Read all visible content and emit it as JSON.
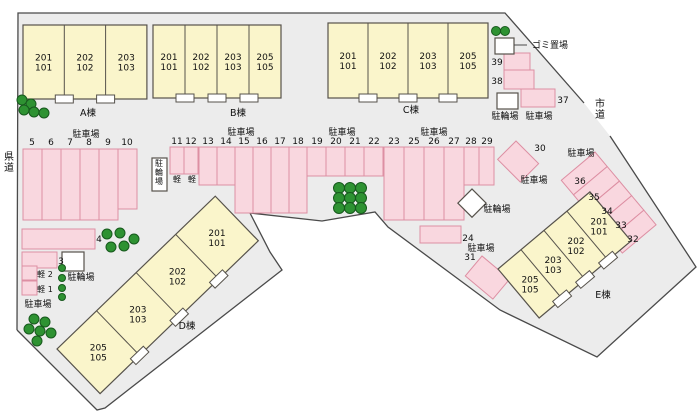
{
  "colors": {
    "parcel": "#ececec",
    "boundary": "#4a4a4a",
    "building_fill": "#faf5cb",
    "building_stroke": "#56524b",
    "stall_fill": "#f9d7df",
    "stall_stroke": "#dd8fa3",
    "tree_fill": "#2e9232",
    "tree_stroke": "#17591d",
    "white_box_fill": "#ffffff",
    "white_box_stroke": "#56524b",
    "text": "#111111"
  },
  "boundary": {
    "fill": "17,330 18,13 505,13 584,103 610,136 696,267 597,357 500,310 388,227 375,212 322,221 250,213 270,252 282,270 105,408 97,410 17,330",
    "outlines": [
      "17,330 18,13 505,13 584,103",
      "610,136 696,267 597,357 500,310 388,227 375,212 322,221 250,213 270,252 282,270 105,408 97,410 17,330"
    ]
  },
  "buildings": [
    {
      "id": "A",
      "label": "A棟",
      "labelPos": [
        88,
        116
      ],
      "origin": [
        23,
        25
      ],
      "unitW": 41.3,
      "depth": 74,
      "rot": 0,
      "units": [
        [
          "201",
          "101"
        ],
        [
          "202",
          "102"
        ],
        [
          "203",
          "103"
        ]
      ]
    },
    {
      "id": "B",
      "label": "B棟",
      "labelPos": [
        238,
        116
      ],
      "origin": [
        153,
        25
      ],
      "unitW": 32,
      "depth": 73,
      "rot": 0,
      "units": [
        [
          "201",
          "101"
        ],
        [
          "202",
          "102"
        ],
        [
          "203",
          "103"
        ],
        [
          "205",
          "105"
        ]
      ]
    },
    {
      "id": "C",
      "label": "C棟",
      "labelPos": [
        411,
        113
      ],
      "origin": [
        328,
        23
      ],
      "unitW": 40,
      "depth": 75,
      "rot": 0,
      "units": [
        [
          "201",
          "101"
        ],
        [
          "202",
          "102"
        ],
        [
          "203",
          "103"
        ],
        [
          "205",
          "105"
        ]
      ]
    },
    {
      "id": "D",
      "label": "D棟",
      "labelPos": [
        187,
        329
      ],
      "origin": [
        57,
        349
      ],
      "unitW": 55,
      "depth": 62,
      "rot": -44,
      "units": [
        [
          "205",
          "105"
        ],
        [
          "203",
          "103"
        ],
        [
          "202",
          "102"
        ],
        [
          "201",
          "101"
        ]
      ]
    },
    {
      "id": "E",
      "label": "E棟",
      "labelPos": [
        603,
        298
      ],
      "origin": [
        498,
        269
      ],
      "unitW": 30,
      "depth": 64,
      "rot": -40,
      "units": [
        [
          "205",
          "105"
        ],
        [
          "203",
          "103"
        ],
        [
          "202",
          "102"
        ],
        [
          "201",
          "101"
        ]
      ]
    }
  ],
  "stalls": [
    {
      "n": "5",
      "x": 23,
      "y": 149,
      "w": 19,
      "h": 71,
      "lx": 32,
      "ly": 145
    },
    {
      "n": "6",
      "x": 42,
      "y": 149,
      "w": 19,
      "h": 71,
      "lx": 51,
      "ly": 145
    },
    {
      "n": "7",
      "x": 61,
      "y": 149,
      "w": 19,
      "h": 71,
      "lx": 70,
      "ly": 145
    },
    {
      "n": "8",
      "x": 80,
      "y": 149,
      "w": 19,
      "h": 71,
      "lx": 89,
      "ly": 145
    },
    {
      "n": "9",
      "x": 99,
      "y": 149,
      "w": 19,
      "h": 71,
      "lx": 108,
      "ly": 145
    },
    {
      "n": "10",
      "x": 118,
      "y": 149,
      "w": 19,
      "h": 60,
      "lx": 127,
      "ly": 145
    },
    {
      "n": "11",
      "x": 170,
      "y": 147,
      "w": 14,
      "h": 27,
      "lx": 177,
      "ly": 144
    },
    {
      "n": "12",
      "x": 184,
      "y": 147,
      "w": 14,
      "h": 27,
      "lx": 191,
      "ly": 144
    },
    {
      "n": "13",
      "x": 199,
      "y": 147,
      "w": 18,
      "h": 38,
      "lx": 208,
      "ly": 144
    },
    {
      "n": "14",
      "x": 217,
      "y": 147,
      "w": 18,
      "h": 38,
      "lx": 226,
      "ly": 144
    },
    {
      "n": "15",
      "x": 235,
      "y": 147,
      "w": 18,
      "h": 66,
      "lx": 244,
      "ly": 144
    },
    {
      "n": "16",
      "x": 253,
      "y": 147,
      "w": 18,
      "h": 66,
      "lx": 262,
      "ly": 144
    },
    {
      "n": "17",
      "x": 271,
      "y": 147,
      "w": 18,
      "h": 66,
      "lx": 280,
      "ly": 144
    },
    {
      "n": "18",
      "x": 289,
      "y": 147,
      "w": 18,
      "h": 66,
      "lx": 298,
      "ly": 144
    },
    {
      "n": "19",
      "x": 307,
      "y": 147,
      "w": 19,
      "h": 29,
      "lx": 317,
      "ly": 144
    },
    {
      "n": "20",
      "x": 326,
      "y": 147,
      "w": 19,
      "h": 29,
      "lx": 336,
      "ly": 144
    },
    {
      "n": "21",
      "x": 345,
      "y": 147,
      "w": 19,
      "h": 29,
      "lx": 355,
      "ly": 144
    },
    {
      "n": "22",
      "x": 364,
      "y": 147,
      "w": 19,
      "h": 29,
      "lx": 374,
      "ly": 144
    },
    {
      "n": "23",
      "x": 384,
      "y": 147,
      "w": 20,
      "h": 73,
      "lx": 394,
      "ly": 144
    },
    {
      "n": "25",
      "x": 404,
      "y": 147,
      "w": 20,
      "h": 73,
      "lx": 414,
      "ly": 144
    },
    {
      "n": "26",
      "x": 424,
      "y": 147,
      "w": 20,
      "h": 73,
      "lx": 434,
      "ly": 144
    },
    {
      "n": "27",
      "x": 444,
      "y": 147,
      "w": 20,
      "h": 73,
      "lx": 454,
      "ly": 144
    },
    {
      "n": "28",
      "x": 464,
      "y": 147,
      "w": 15,
      "h": 38,
      "lx": 471,
      "ly": 144
    },
    {
      "n": "29",
      "x": 479,
      "y": 147,
      "w": 15,
      "h": 38,
      "lx": 487,
      "ly": 144
    },
    {
      "n": "24",
      "x": 420,
      "y": 226,
      "w": 41,
      "h": 17,
      "lx": 468,
      "ly": 241
    },
    {
      "n": "4",
      "x": 22,
      "y": 229,
      "w": 73,
      "h": 20,
      "lx": 99,
      "ly": 242
    },
    {
      "n": "3",
      "x": 22,
      "y": 252,
      "w": 35,
      "h": 16,
      "lx": 61,
      "ly": 264
    },
    {
      "n": "",
      "name": "stall-kei-2",
      "x": 22,
      "y": 266,
      "w": 15,
      "h": 14,
      "lx": 0,
      "ly": 0
    },
    {
      "n": "",
      "name": "stall-kei-1",
      "x": 22,
      "y": 281,
      "w": 15,
      "h": 14,
      "lx": 0,
      "ly": 0
    },
    {
      "n": "39",
      "x": 504,
      "y": 53,
      "w": 26,
      "h": 17,
      "lx": 497,
      "ly": 65
    },
    {
      "n": "38",
      "x": 504,
      "y": 70,
      "w": 30,
      "h": 19,
      "lx": 497,
      "ly": 84
    },
    {
      "n": "37",
      "x": 521,
      "y": 89,
      "w": 34,
      "h": 18,
      "lx": 563,
      "ly": 103
    },
    {
      "n": "30",
      "x": 516,
      "y": 141,
      "w": 32,
      "h": 26,
      "rot": "45 516 141",
      "lx": 540,
      "ly": 151
    },
    {
      "n": "31",
      "x": 482,
      "y": 256,
      "w": 36,
      "h": 26,
      "rot": "40 482 256",
      "lx": 470,
      "ly": 260
    },
    {
      "n": "36",
      "x": 595,
      "y": 152,
      "w": 19,
      "h": 44,
      "rot": "50 595 152",
      "lx": 580,
      "ly": 184
    },
    {
      "n": "35",
      "x": 614,
      "y": 152,
      "w": 19,
      "h": 44,
      "rot": "50 595 152",
      "lx": 594,
      "ly": 200
    },
    {
      "n": "34",
      "x": 633,
      "y": 152,
      "w": 19,
      "h": 44,
      "rot": "50 595 152",
      "lx": 607,
      "ly": 214
    },
    {
      "n": "33",
      "x": 652,
      "y": 152,
      "w": 19,
      "h": 44,
      "rot": "50 595 152",
      "lx": 621,
      "ly": 228
    },
    {
      "n": "32",
      "x": 671,
      "y": 152,
      "w": 19,
      "h": 44,
      "rot": "50 595 152",
      "lx": 633,
      "ly": 242
    }
  ],
  "white_boxes": [
    {
      "name": "garbage-box",
      "x": 495,
      "y": 38,
      "w": 19,
      "h": 16
    },
    {
      "name": "bicycle-box-topright",
      "x": 497,
      "y": 93,
      "w": 21,
      "h": 16
    },
    {
      "name": "bicycle-box-left",
      "x": 62,
      "y": 252,
      "w": 22,
      "h": 19
    },
    {
      "name": "bicycle-diamond-center",
      "x": 472,
      "y": 189,
      "w": 20,
      "h": 20,
      "rot": "45 472 189"
    },
    {
      "name": "bicycle-box-mid",
      "x": 152,
      "y": 158,
      "w": 15,
      "h": 33
    }
  ],
  "texts": [
    {
      "t": "県道",
      "x": 9,
      "y": 160,
      "s": 10,
      "v": 1,
      "name": "prefectural-road-label"
    },
    {
      "t": "市道",
      "x": 600,
      "y": 107,
      "s": 10,
      "v": 1,
      "name": "city-road-label"
    },
    {
      "t": "ゴミ置場",
      "x": 550,
      "y": 48,
      "s": 9,
      "name": "garbage-area-label"
    },
    {
      "t": "駐車場",
      "x": 86,
      "y": 137,
      "s": 9,
      "name": "parking-lot-label"
    },
    {
      "t": "駐車場",
      "x": 241,
      "y": 135,
      "s": 9,
      "name": "parking-lot-label"
    },
    {
      "t": "駐車場",
      "x": 342,
      "y": 135,
      "s": 9,
      "name": "parking-lot-label"
    },
    {
      "t": "駐車場",
      "x": 434,
      "y": 135,
      "s": 9,
      "name": "parking-lot-label"
    },
    {
      "t": "駐輪場",
      "x": 505,
      "y": 119,
      "s": 9,
      "name": "bicycle-parking-label"
    },
    {
      "t": "駐車場",
      "x": 539,
      "y": 119,
      "s": 9,
      "name": "parking-lot-label"
    },
    {
      "t": "駐車場",
      "x": 581,
      "y": 156,
      "s": 9,
      "name": "parking-lot-label"
    },
    {
      "t": "駐車場",
      "x": 534,
      "y": 183,
      "s": 9,
      "name": "parking-lot-label"
    },
    {
      "t": "駐輪場",
      "x": 497,
      "y": 212,
      "s": 9,
      "name": "bicycle-parking-label"
    },
    {
      "t": "駐車場",
      "x": 481,
      "y": 251,
      "s": 9,
      "name": "parking-lot-label"
    },
    {
      "t": "駐輪場",
      "x": 81,
      "y": 280,
      "s": 9,
      "name": "bicycle-parking-label"
    },
    {
      "t": "駐車場",
      "x": 38,
      "y": 307,
      "s": 9,
      "name": "parking-lot-label"
    },
    {
      "t": "駐輪場",
      "x": 159,
      "y": 166,
      "s": 8,
      "v": 1,
      "name": "bicycle-parking-label"
    },
    {
      "t": "軽",
      "x": 177,
      "y": 182,
      "s": 8,
      "name": "kei-stall-label"
    },
    {
      "t": "軽",
      "x": 192,
      "y": 182,
      "s": 8,
      "name": "kei-stall-label"
    },
    {
      "t": "軽 2",
      "x": 45,
      "y": 277,
      "s": 8,
      "name": "kei-stall-label"
    },
    {
      "t": "軽 1",
      "x": 45,
      "y": 292,
      "s": 8,
      "name": "kei-stall-label"
    }
  ],
  "lines": [
    {
      "pts": "514,45 527,45",
      "name": "garbage-pointer-line"
    }
  ],
  "trees": [
    {
      "cx": 22,
      "cy": 100,
      "r": 5
    },
    {
      "cx": 31,
      "cy": 104,
      "r": 5
    },
    {
      "cx": 24,
      "cy": 110,
      "r": 5
    },
    {
      "cx": 34,
      "cy": 112,
      "r": 5
    },
    {
      "cx": 44,
      "cy": 113,
      "r": 5
    },
    {
      "cx": 496,
      "cy": 31,
      "r": 4.5
    },
    {
      "cx": 505,
      "cy": 31,
      "r": 4.5
    },
    {
      "cx": 339,
      "cy": 188,
      "r": 5.5
    },
    {
      "cx": 350,
      "cy": 188,
      "r": 5.5
    },
    {
      "cx": 361,
      "cy": 188,
      "r": 5.5
    },
    {
      "cx": 339,
      "cy": 198,
      "r": 5.5
    },
    {
      "cx": 350,
      "cy": 198,
      "r": 5.5
    },
    {
      "cx": 361,
      "cy": 198,
      "r": 5.5
    },
    {
      "cx": 339,
      "cy": 208,
      "r": 5.5
    },
    {
      "cx": 350,
      "cy": 208,
      "r": 5.5
    },
    {
      "cx": 361,
      "cy": 208,
      "r": 5.5
    },
    {
      "cx": 62,
      "cy": 268,
      "r": 3.5
    },
    {
      "cx": 62,
      "cy": 278,
      "r": 3.5
    },
    {
      "cx": 62,
      "cy": 288,
      "r": 3.5
    },
    {
      "cx": 62,
      "cy": 297,
      "r": 3.5
    },
    {
      "cx": 107,
      "cy": 234,
      "r": 5
    },
    {
      "cx": 120,
      "cy": 233,
      "r": 5
    },
    {
      "cx": 111,
      "cy": 247,
      "r": 5
    },
    {
      "cx": 124,
      "cy": 246,
      "r": 5
    },
    {
      "cx": 134,
      "cy": 239,
      "r": 5
    },
    {
      "cx": 34,
      "cy": 319,
      "r": 5
    },
    {
      "cx": 45,
      "cy": 322,
      "r": 5
    },
    {
      "cx": 29,
      "cy": 329,
      "r": 5
    },
    {
      "cx": 40,
      "cy": 331,
      "r": 5
    },
    {
      "cx": 51,
      "cy": 333,
      "r": 5
    },
    {
      "cx": 37,
      "cy": 341,
      "r": 5
    }
  ]
}
